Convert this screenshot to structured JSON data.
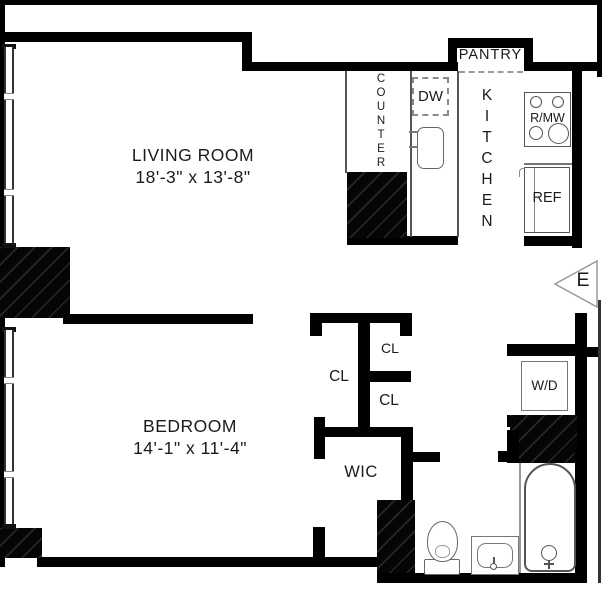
{
  "plan_title": "apartment-floor-plan",
  "colors": {
    "wall": "#000000",
    "fixture_line": "#666666",
    "text": "#1b1b1b",
    "marker_outline": "#999999"
  },
  "rooms": {
    "living_room": {
      "name": "LIVING ROOM",
      "dims": "18'-3\" x 13'-8\""
    },
    "bedroom": {
      "name": "BEDROOM",
      "dims": "14'-1\" x 11'-4\""
    },
    "kitchen": {
      "label": "KITCHEN"
    },
    "pantry": {
      "label": "PANTRY"
    },
    "counter": {
      "label": "COUNTER"
    },
    "wic": {
      "label": "WIC"
    }
  },
  "closets": [
    {
      "label": "CL"
    },
    {
      "label": "CL"
    },
    {
      "label": "CL"
    }
  ],
  "appliances": {
    "dishwasher": "DW",
    "range_microwave": "R/MW",
    "refrigerator": "REF",
    "washer_dryer": "W/D"
  },
  "compass": {
    "east": "E"
  }
}
